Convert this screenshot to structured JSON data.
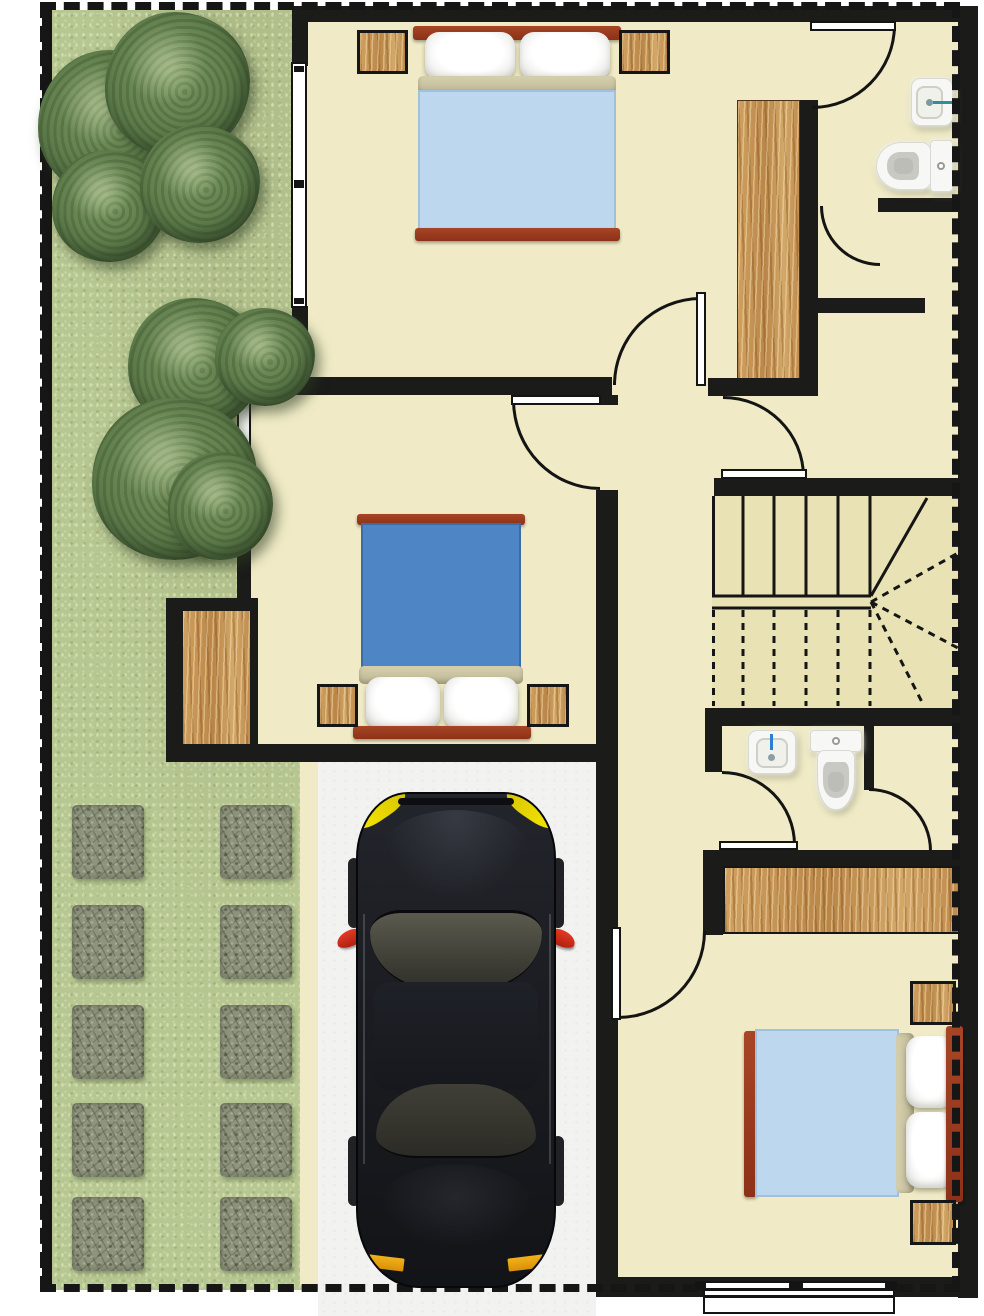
{
  "palette": {
    "wall": "#1b1b19",
    "floor": "#f0ebc6",
    "stair_floor": "#e8e2b4",
    "grass": "#b7c791",
    "tree": "#5d7b4a",
    "paver": "#8f947d",
    "wood": "#c9995a",
    "driveway": "#f2f2f1",
    "boundary": "#161616",
    "bed_frame": "#993a20",
    "bed_fold": "#cac4a2",
    "blanket_light_blue": "#bcd7ee",
    "blanket_blue": "#4e86c5",
    "pillow": "#ffffff",
    "porcelain": "#f7f7f5",
    "faucet_teal": "#2e8f96",
    "faucet_blue": "#2b7fd4",
    "car_body": "#1b1d22",
    "car_glass": "#4b4a40",
    "headlight": "#f4e400",
    "taillight": "#eda317",
    "mirror": "#dd3222"
  },
  "site": {
    "boundary": "dashed property line",
    "yard": {
      "name": "side yard with lawn",
      "tree_clusters": 2,
      "stepping_stones": {
        "rows": 5,
        "columns": 2
      }
    },
    "driveway": {
      "name": "driveway",
      "vehicle": "black sedan seen from above"
    }
  },
  "rooms": [
    {
      "name": "bedroom-top",
      "furniture": [
        "double bed with light blue blanket",
        "nightstand",
        "nightstand",
        "wardrobe"
      ],
      "openings": [
        "window west",
        "door south",
        "door to ensuite bathroom"
      ]
    },
    {
      "name": "ensuite-bathroom",
      "furniture": [
        "wash basin",
        "toilet"
      ],
      "openings": [
        "door from bedroom",
        "door to dressing hall"
      ]
    },
    {
      "name": "dressing-hall",
      "furniture": [
        "built-in wardrobe"
      ],
      "openings": [
        "door to landing"
      ]
    },
    {
      "name": "hallway-landing",
      "furniture": [],
      "openings": [
        "door to bedroom-top",
        "door to bedroom-middle",
        "door to dressing hall"
      ]
    },
    {
      "name": "bedroom-middle",
      "furniture": [
        "double bed with blue blanket",
        "nightstand",
        "nightstand",
        "closet alcove"
      ],
      "openings": [
        "window west",
        "door east"
      ]
    },
    {
      "name": "stairwell",
      "furniture": [
        "L-shaped staircase with winder treads"
      ],
      "openings": []
    },
    {
      "name": "bathroom-lower",
      "furniture": [
        "wash basin",
        "toilet"
      ],
      "openings": [
        "door from corridor",
        "door to shower compartment"
      ]
    },
    {
      "name": "bedroom-bottom",
      "furniture": [
        "double bed with light blue blanket",
        "nightstand",
        "nightstand",
        "wardrobe"
      ],
      "openings": [
        "window south",
        "door from corridor"
      ]
    }
  ],
  "car": {
    "type": "sedan top view",
    "features": [
      "yellow headlights",
      "windshield",
      "roof",
      "rear window",
      "red side mirrors",
      "orange taillights",
      "four wheels"
    ]
  }
}
